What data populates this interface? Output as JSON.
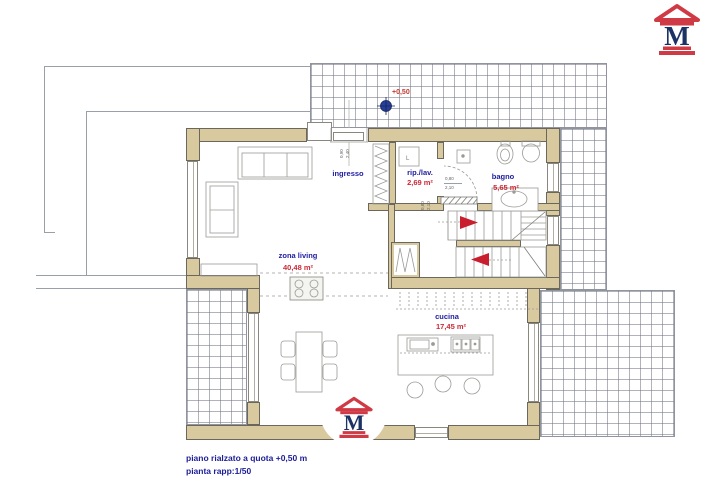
{
  "title": {
    "line1": "piano rialzato a quota +0,50 m",
    "line2": "pianta rapp:1/50"
  },
  "rooms": {
    "ingresso": {
      "label": "ingresso"
    },
    "rip_lav": {
      "label": "rip./lav.",
      "area": "2,69 m²"
    },
    "bagno": {
      "label": "bagno",
      "area": "5,65 m²"
    },
    "zona_living": {
      "label": "zona living",
      "area": "40,48 m²"
    },
    "cucina": {
      "label": "cucina",
      "area": "17,45 m²"
    }
  },
  "annotations": {
    "level": "+0,50",
    "entry_door": {
      "w": "0,90",
      "h": "2,40"
    },
    "bagno_door": {
      "w": "0,80",
      "h": "2,10"
    },
    "riplav_door": {
      "w": "0,80",
      "h": "2,10"
    },
    "washer": "L"
  },
  "logo": {
    "letter": "M"
  },
  "colors": {
    "wall": "#d9c99f",
    "navy_text": "#1c1ca0",
    "area_red": "#cc2936",
    "arrow_red": "#c81e2e",
    "logo_red": "#cf3a45",
    "logo_navy": "#1d3264",
    "grid_line": "#8f949e"
  }
}
